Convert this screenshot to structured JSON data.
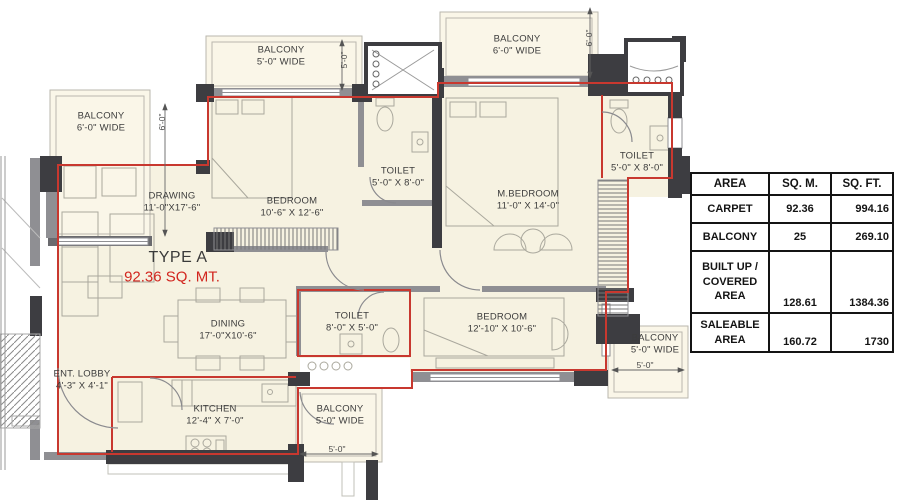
{
  "plan": {
    "type_label": "TYPE A",
    "type_area": "92.36 SQ. MT.",
    "rooms": [
      {
        "name": "BALCONY",
        "dims": "6'-0\" WIDE"
      },
      {
        "name": "BALCONY",
        "dims": "5'-0\" WIDE"
      },
      {
        "name": "BALCONY",
        "dims": "6'-0\" WIDE"
      },
      {
        "name": "DRAWING",
        "dims": "11'-0\"X17'-6\""
      },
      {
        "name": "BEDROOM",
        "dims": "10'-6\" X 12'-6\""
      },
      {
        "name": "TOILET",
        "dims": "5'-0\" X 8'-0\""
      },
      {
        "name": "M.BEDROOM",
        "dims": "11'-0\" X 14'-0\""
      },
      {
        "name": "TOILET",
        "dims": "5'-0\" X 8'-0\""
      },
      {
        "name": "DINING",
        "dims": "17'-0\"X10'-6\""
      },
      {
        "name": "TOILET",
        "dims": "8'-0\" X 5'-0\""
      },
      {
        "name": "BEDROOM",
        "dims": "12'-10\" X 10'-6\""
      },
      {
        "name": "BALCONY",
        "dims": "5'-0\" WIDE"
      },
      {
        "name": "ENT. LOBBY",
        "dims": "4'-3\" X 4'-1\""
      },
      {
        "name": "KITCHEN",
        "dims": "12'-4\" X 7'-0\""
      },
      {
        "name": "BALCONY",
        "dims": "5'-0\" WIDE"
      }
    ],
    "dimension_labels": {
      "balcony_left": "6'-0\"",
      "balcony_top": "5'-0\"",
      "balcony_top_right": "6'-0\"",
      "balcony_right_bottom": "5'-0\"",
      "balcony_bottom": "5'-0\""
    }
  },
  "area_table": {
    "headers": [
      "AREA",
      "SQ. M.",
      "SQ. FT."
    ],
    "rows": [
      {
        "label": "CARPET",
        "sqm": "92.36",
        "sqft": "994.16"
      },
      {
        "label": "BALCONY",
        "sqm": "25",
        "sqft": "269.10"
      },
      {
        "label": "BUILT UP /\nCOVERED\nAREA",
        "sqm": "128.61",
        "sqft": "1384.36"
      },
      {
        "label": "SALEABLE\nAREA",
        "sqm": "160.72",
        "sqft": "1730"
      }
    ]
  },
  "colors": {
    "unit_outline": "#c8382f",
    "wall_dark": "#3d3d41",
    "wall_gray": "#8f8f93",
    "floor": "#f6f2e1",
    "balcony_floor": "#faf6e8",
    "accent_text": "#d2261f"
  }
}
